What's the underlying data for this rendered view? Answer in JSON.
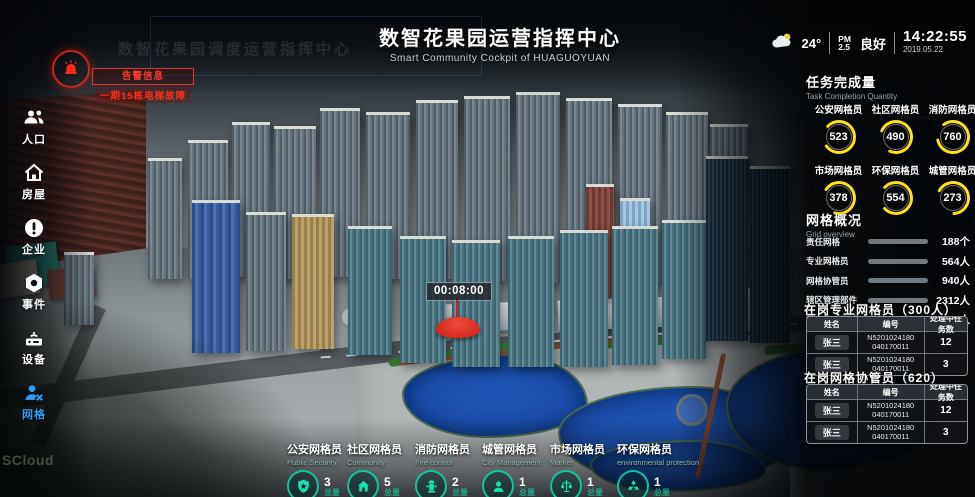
{
  "header": {
    "title": "数智花果园运营指挥中心",
    "subtitle": "Smart Community Cockpit of HUAGUOYUAN",
    "ghost_title": "数智花果园调度运营指挥中心"
  },
  "status_bar": {
    "temperature": "24°",
    "pm_label": "PM",
    "pm_value": "2.5",
    "air_quality": "良好",
    "time": "14:22:55",
    "date": "2019.05.22"
  },
  "alarm": {
    "title": "告警信息",
    "message": "一期15栋电梯故障"
  },
  "sidebar": {
    "items": [
      {
        "label": "人口",
        "icon": "people-icon",
        "active": false
      },
      {
        "label": "房屋",
        "icon": "house-icon",
        "active": false
      },
      {
        "label": "企业",
        "icon": "enterprise-icon",
        "active": false
      },
      {
        "label": "事件",
        "icon": "event-icon",
        "active": false
      },
      {
        "label": "设备",
        "icon": "device-icon",
        "active": false
      },
      {
        "label": "网格",
        "icon": "grid-icon",
        "active": true
      }
    ]
  },
  "task_completion": {
    "title": "任务完成量",
    "subtitle": "Task Completion Quantity",
    "gauges": [
      {
        "label": "公安网格员",
        "value": 523
      },
      {
        "label": "社区网格员",
        "value": 490
      },
      {
        "label": "消防网格员",
        "value": 760
      },
      {
        "label": "市场网格员",
        "value": 378
      },
      {
        "label": "环保网格员",
        "value": 554
      },
      {
        "label": "城管网格员",
        "value": 273
      }
    ]
  },
  "grid_overview": {
    "title": "网格概况",
    "subtitle": "Grid overview",
    "rows": [
      {
        "label": "责任网格",
        "value": "188个",
        "pct": 78
      },
      {
        "label": "专业网格员",
        "value": "564人",
        "pct": 56
      },
      {
        "label": "网格协管员",
        "value": "940人",
        "pct": 50
      },
      {
        "label": "辖区管理部件",
        "value": "2312人",
        "pct": 95
      },
      {
        "label": "重点管理区域",
        "value": "276人",
        "pct": 46
      }
    ]
  },
  "on_duty_professional": {
    "title": "在岗专业网格员（300人）",
    "headers": [
      "姓名",
      "编号",
      "处理中任务数"
    ],
    "rows": [
      {
        "name": "张三",
        "code_line1": "N5201024180",
        "code_line2": "040170011",
        "tasks": "12"
      },
      {
        "name": "张三",
        "code_line1": "N5201024180",
        "code_line2": "040170011",
        "tasks": "3"
      }
    ]
  },
  "on_duty_assistant": {
    "title": "在岗网格协管员（620）",
    "headers": [
      "姓名",
      "编号",
      "处理中任务数"
    ],
    "rows": [
      {
        "name": "张三",
        "code_line1": "N5201024180",
        "code_line2": "040170011",
        "tasks": "12"
      },
      {
        "name": "张三",
        "code_line1": "N5201024180",
        "code_line2": "040170011",
        "tasks": "3"
      }
    ]
  },
  "bottom_stats": {
    "items": [
      {
        "label": "公安网格员",
        "en": "Public Security",
        "icon": "shield-star-icon",
        "value": "3",
        "unit": "总量"
      },
      {
        "label": "社区网格员",
        "en": "Community",
        "icon": "home-icon",
        "value": "5",
        "unit": "总量"
      },
      {
        "label": "消防网格员",
        "en": "Fire control",
        "icon": "hydrant-icon",
        "value": "2",
        "unit": "总量"
      },
      {
        "label": "城管网格员",
        "en": "City Management",
        "icon": "officer-icon",
        "value": "1",
        "unit": "总量"
      },
      {
        "label": "市场网格员",
        "en": "Market",
        "icon": "scales-icon",
        "value": "1",
        "unit": "总量"
      },
      {
        "label": "环保网格员",
        "en": "environmental protection",
        "icon": "recycle-icon",
        "value": "1",
        "unit": "总量"
      }
    ]
  },
  "map": {
    "timer": "00:08:00"
  },
  "watermark": "SCloud",
  "colors": {
    "accent_yellow": "#ffe11a",
    "accent_blue": "#2d9bf5",
    "accent_teal": "#11e0b0",
    "alarm_red": "#e81515"
  }
}
